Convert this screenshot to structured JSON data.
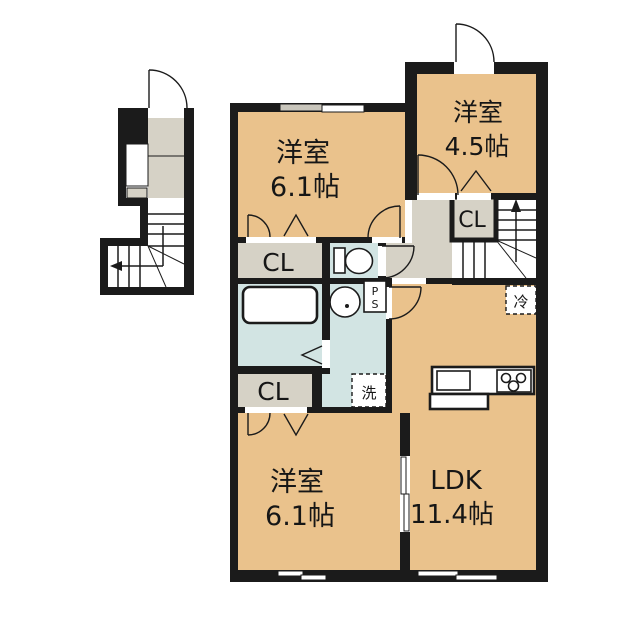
{
  "plan": {
    "colors": {
      "room": "#EAC28C",
      "closet": "#D6D2C6",
      "wet": "#D2E4E3",
      "wall": "#1B1B1B",
      "window_shade": "#C9C6BC",
      "bg": "#FFFFFF"
    },
    "rooms": [
      {
        "label": "洋室",
        "size": "6.1帖"
      },
      {
        "label": "洋室",
        "size": "4.5帖"
      },
      {
        "label": "洋室",
        "size": "6.1帖"
      },
      {
        "label": "LDK",
        "size": "11.4帖"
      }
    ],
    "closets": [
      {
        "label": "CL"
      },
      {
        "label": "CL"
      },
      {
        "label": "CL"
      }
    ],
    "fixtures": {
      "refrigerator": "冷",
      "washing_machine": "洗",
      "pipe_space_p": "P",
      "pipe_space_s": "S"
    }
  }
}
